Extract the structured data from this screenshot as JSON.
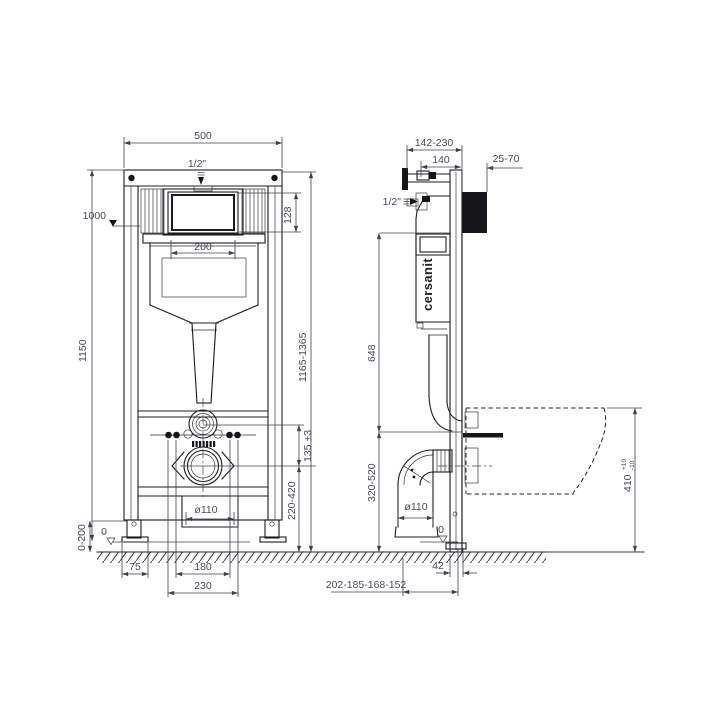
{
  "drawing": {
    "brand": "cersanit",
    "front": {
      "width_total": "500",
      "inlet": "1/2\"",
      "level_mark": "1000",
      "opening_height": "128",
      "opening_width": "200",
      "frame_height": "1150",
      "install_height": "1165-1365",
      "inlet_to_drain": "135 ±3",
      "drain_height": "220-420",
      "drain_dia": "ø110",
      "leg_range": "0-200",
      "zero": "0",
      "foot_width": "75",
      "stud_spacing_inner": "180",
      "stud_spacing_outer": "230"
    },
    "side": {
      "depth_range": "142-230",
      "depth": "140",
      "wall_range": "25-70",
      "inlet": "1/2\"",
      "upper_span": "648",
      "lower_span": "320-520",
      "drain_dia": "ø110",
      "bowl_height": "410",
      "bowl_tol_plus": "+10",
      "bowl_tol_minus": "-10",
      "zero": "0",
      "pipe_wall_offset": "42",
      "drain_depth_series": "202-185-168-152"
    }
  }
}
